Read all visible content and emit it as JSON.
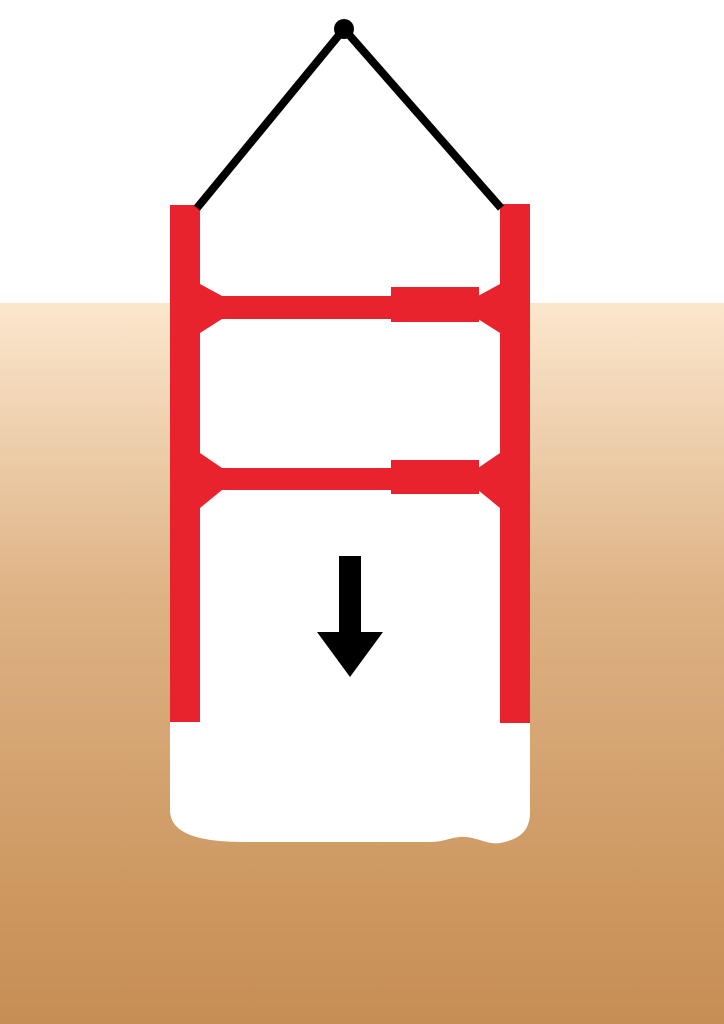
{
  "diagram": {
    "canvas": {
      "width": 724,
      "height": 1024
    },
    "colors": {
      "sky_white": "#FFFFFF",
      "excavation_white": "#FFFFFF",
      "shoring_red": "#E8232D",
      "line_black": "#000000",
      "soil_top": "#FBE7CD",
      "soil_bottom": "#C68E55"
    },
    "ground_level_y": 303,
    "sky": {
      "x": 0,
      "y": 0,
      "width": 724,
      "height": 303,
      "fill": "#FFFFFF"
    },
    "soil": {
      "x": 0,
      "y": 303,
      "width": 724,
      "height": 721,
      "fill": "url(#soilGradient)"
    },
    "soil_gradient_stops": [
      {
        "offset": "0%",
        "stop-color": "#FBE7CD"
      },
      {
        "offset": "41%",
        "stop-color": "#DEB284"
      },
      {
        "offset": "69%",
        "stop-color": "#D2A06C"
      },
      {
        "offset": "83%",
        "stop-color": "#CD9760"
      },
      {
        "offset": "100%",
        "stop-color": "#C68E55"
      }
    ],
    "excavation_cavity": {
      "d": "M170,303 L530,303 L530,812 C530,830 521,839 500,843 C489,845 478,838 466,837 C452,836 446,842 430,842 L245,842 C205,842 170,836 170,810 Z",
      "fill": "#FFFFFF"
    },
    "rails": {
      "left": {
        "x": 170,
        "y": 205,
        "width": 30,
        "height": 517,
        "fill": "#E8232D"
      },
      "right": {
        "x": 500,
        "y": 204,
        "width": 30,
        "height": 519,
        "fill": "#E8232D"
      }
    },
    "braces": {
      "upper": {
        "bar": {
          "x": 200,
          "y": 296,
          "width": 300,
          "height": 23,
          "fill": "#E8232D"
        },
        "collar": {
          "x": 391,
          "y": 287,
          "width": 88,
          "height": 35,
          "fill": "#E8232D"
        },
        "left_flange": {
          "points": "200,284 222,296 222,319 200,333",
          "fill": "#E8232D"
        },
        "right_flange": {
          "points": "500,284 478,296 478,319 500,333",
          "fill": "#E8232D"
        }
      },
      "lower": {
        "bar": {
          "x": 200,
          "y": 468,
          "width": 300,
          "height": 22,
          "fill": "#E8232D"
        },
        "collar": {
          "x": 391,
          "y": 460,
          "width": 88,
          "height": 34,
          "fill": "#E8232D"
        },
        "left_flange": {
          "points": "200,453 222,468 222,490 200,508",
          "fill": "#E8232D"
        },
        "right_flange": {
          "points": "500,453 478,468 478,490 500,508",
          "fill": "#E8232D"
        }
      }
    },
    "sling": {
      "left_leg": {
        "x1": 344,
        "y1": 29,
        "x2": 197,
        "y2": 208,
        "stroke": "#000000",
        "stroke-width": 8
      },
      "right_leg": {
        "x1": 344,
        "y1": 29,
        "x2": 501,
        "y2": 208,
        "stroke": "#000000",
        "stroke-width": 8
      },
      "apex_dot": {
        "cx": 344,
        "cy": 29,
        "r": 10,
        "fill": "#000000"
      }
    },
    "lowering_arrow": {
      "points": "339,556 361,556 361,632 383,632 350,677 317,632 339,632",
      "fill": "#000000"
    }
  }
}
